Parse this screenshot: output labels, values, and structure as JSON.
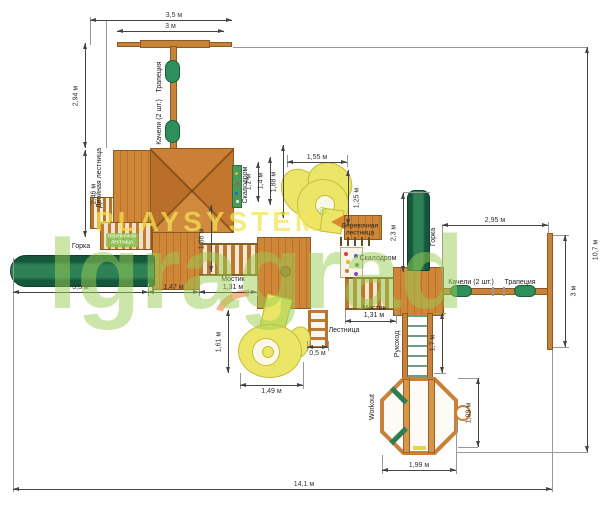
{
  "watermark": {
    "yellow": "PLAYSYSTEM",
    "green": "Igragrad",
    "registered": "®"
  },
  "part_labels": [
    {
      "name": "label-trapeze-top",
      "text": "Трапеция",
      "x": 160,
      "y": 77,
      "rot": true
    },
    {
      "name": "label-swings-top",
      "text": "Качели (2 шт.)",
      "x": 160,
      "y": 122,
      "rot": true
    },
    {
      "name": "label-double-ladder",
      "text": "Двойная лестница",
      "x": 100,
      "y": 178,
      "rot": true
    },
    {
      "name": "label-slide-left",
      "text": "Горка",
      "x": 81,
      "y": 247
    },
    {
      "name": "label-rope-ladder-left",
      "text": "Веревочная\nлестница",
      "x": 122,
      "y": 240,
      "cls": "chip"
    },
    {
      "name": "label-climbwall-top",
      "text": "Скалодром",
      "x": 246,
      "y": 185,
      "rot": true
    },
    {
      "name": "label-rope-ladder-mid",
      "text": "Веревочная\nлестница",
      "x": 360,
      "y": 230,
      "cls": "small2"
    },
    {
      "name": "label-climbwall-mid",
      "text": "Скалодром",
      "x": 378,
      "y": 259
    },
    {
      "name": "label-slide-right",
      "text": "Горка",
      "x": 434,
      "y": 237,
      "rot": true
    },
    {
      "name": "label-swings-right",
      "text": "Качели (2 шт.)",
      "x": 471,
      "y": 283
    },
    {
      "name": "label-trapeze-right",
      "text": "Трапеция",
      "x": 520,
      "y": 283
    },
    {
      "name": "label-bridge-left-name",
      "text": "Мостик",
      "x": 233,
      "y": 280
    },
    {
      "name": "label-bridge-left-size",
      "text": "1,31 м",
      "x": 233,
      "y": 288
    },
    {
      "name": "label-bridge-right-name",
      "text": "Мостик",
      "x": 374,
      "y": 309
    },
    {
      "name": "label-bridge-right-size",
      "text": "1,31 м",
      "x": 374,
      "y": 316
    },
    {
      "name": "label-ladder-center",
      "text": "Лестница",
      "x": 344,
      "y": 331
    },
    {
      "name": "label-monkey-bars",
      "text": "Рукоход",
      "x": 398,
      "y": 344,
      "rot": true
    },
    {
      "name": "label-workout",
      "text": "Workout",
      "x": 373,
      "y": 407,
      "rot": true
    }
  ],
  "dim_h": [
    {
      "label": "3,5 м",
      "x1": 90,
      "x2": 232,
      "y": 20,
      "lx": 174
    },
    {
      "label": "3 м",
      "x1": 117,
      "x2": 224,
      "y": 31
    },
    {
      "label": "1,55 м",
      "x1": 287,
      "x2": 347,
      "y": 162
    },
    {
      "label": "2,95 м",
      "x1": 442,
      "x2": 548,
      "y": 225
    },
    {
      "label": "3,3 м",
      "x1": 13,
      "x2": 148,
      "y": 292
    },
    {
      "label": "1,47 м",
      "x1": 148,
      "x2": 199,
      "y": 292
    },
    {
      "label": "",
      "x1": 199,
      "x2": 257,
      "y": 292
    },
    {
      "label": "",
      "x1": 345,
      "x2": 396,
      "y": 321
    },
    {
      "label": "0,5 м",
      "x1": 307,
      "x2": 328,
      "y": 347,
      "pos": "below"
    },
    {
      "label": "1,49 м",
      "x1": 240,
      "x2": 303,
      "y": 385,
      "pos": "below"
    },
    {
      "label": "1,99 м",
      "x1": 382,
      "x2": 456,
      "y": 470
    },
    {
      "label": "14,1 м",
      "x1": 13,
      "x2": 552,
      "y": 489,
      "lx": 304
    }
  ],
  "dim_v": [
    {
      "label": "2,94 м",
      "x": 85,
      "y1": 43,
      "y2": 148,
      "side": "left"
    },
    {
      "label": "2,46 м",
      "x": 85,
      "y1": 150,
      "y2": 237,
      "side": "right"
    },
    {
      "label": "1,86 м",
      "x": 211,
      "y1": 205,
      "y2": 272,
      "side": "left"
    },
    {
      "label": "1,2 м",
      "x": 258,
      "y1": 162,
      "y2": 202,
      "side": "left"
    },
    {
      "label": "1,4 м",
      "x": 270,
      "y1": 157,
      "y2": 205,
      "side": "left"
    },
    {
      "label": "1,88 м",
      "x": 283,
      "y1": 145,
      "y2": 218,
      "side": "left"
    },
    {
      "label": "1,25 м",
      "x": 348,
      "y1": 170,
      "y2": 225,
      "side": "right"
    },
    {
      "label": "2,3 м",
      "x": 403,
      "y1": 193,
      "y2": 272,
      "side": "left"
    },
    {
      "label": "3 м",
      "x": 565,
      "y1": 235,
      "y2": 347,
      "side": "right"
    },
    {
      "label": "10,7 м",
      "x": 587,
      "y1": 47,
      "y2": 452,
      "side": "right"
    },
    {
      "label": "1,61 м",
      "x": 228,
      "y1": 310,
      "y2": 373,
      "side": "left"
    },
    {
      "label": "1,7 м",
      "x": 442,
      "y1": 313,
      "y2": 373,
      "side": "left"
    },
    {
      "label": "1,99 м",
      "x": 478,
      "y1": 378,
      "y2": 447,
      "side": "left"
    }
  ]
}
